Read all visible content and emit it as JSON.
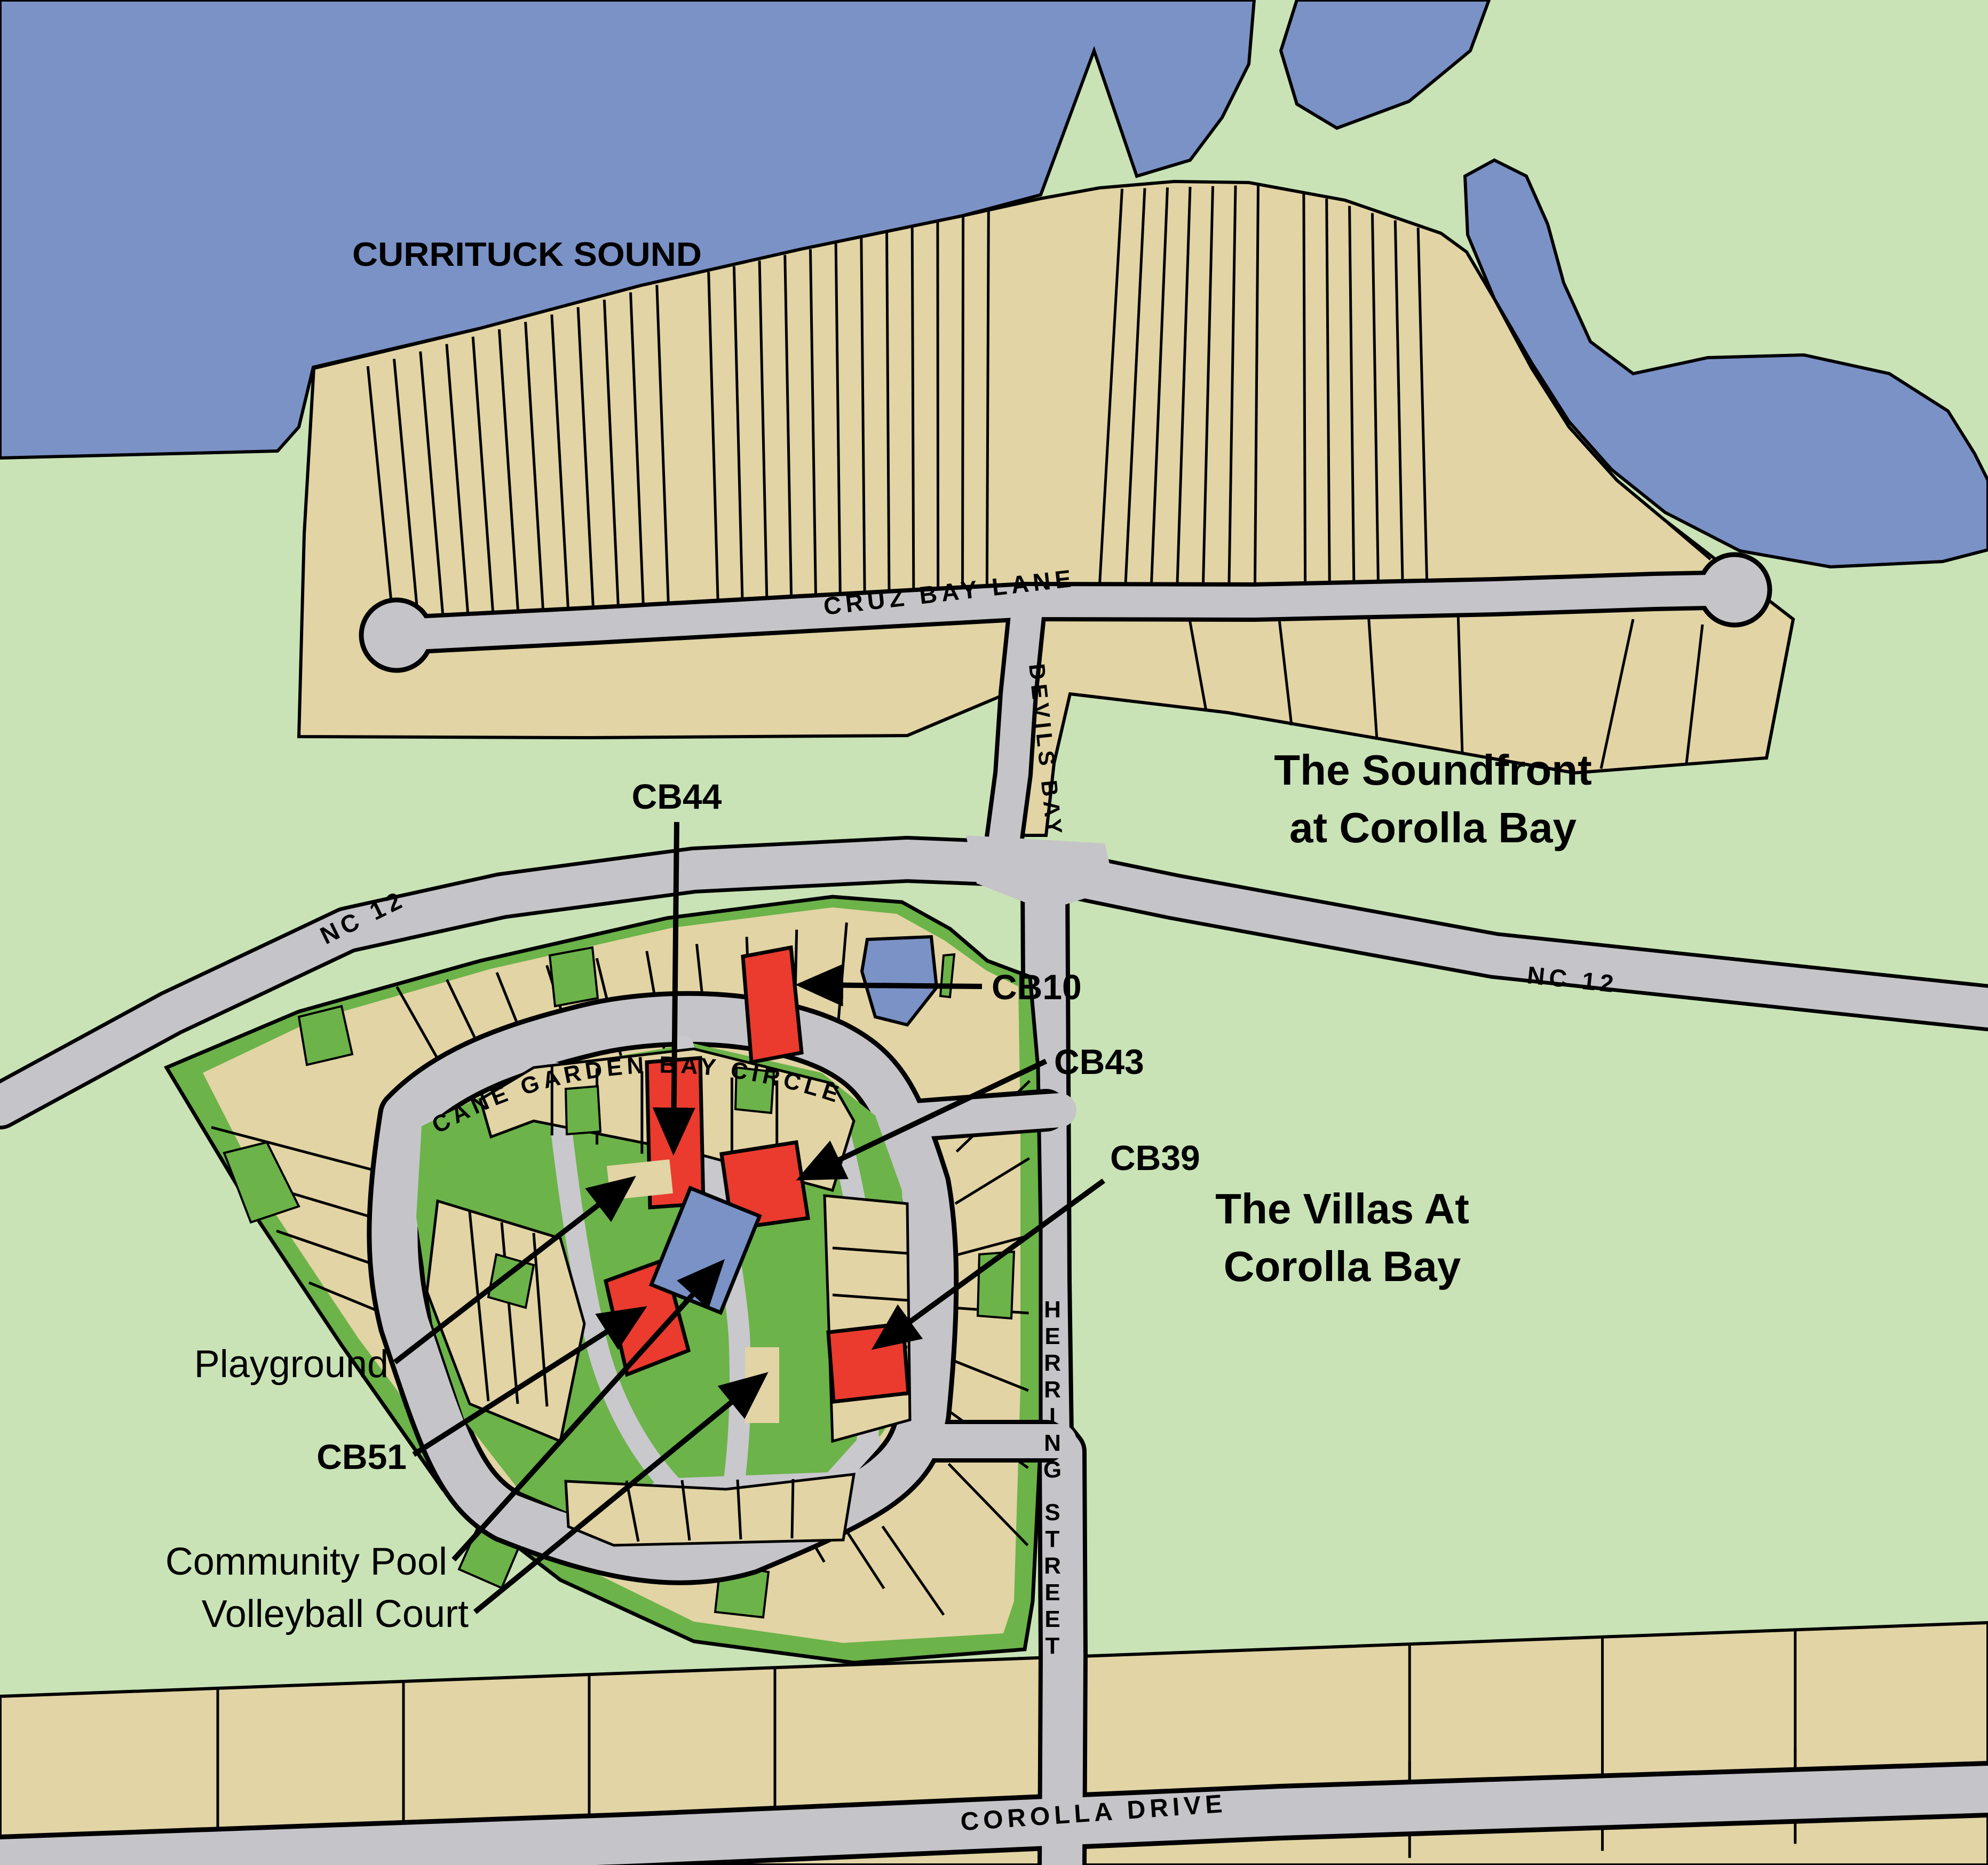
{
  "map": {
    "water_label": "CURRITUCK SOUND",
    "areas": {
      "soundfront_line1": "The Soundfront",
      "soundfront_line2": "at Corolla Bay",
      "villas_line1": "The Villas At",
      "villas_line2": "Corolla Bay"
    },
    "roads": {
      "cruz_bay_lane": "CRUZ BAY LANE",
      "devils_bay": "DEVILS BAY",
      "nc12_west": "NC 12",
      "nc12_east": "NC 12",
      "cane_garden_bay_circle": "CANE GARDEN BAY CIRCLE",
      "herring_street": "HERRING STREET",
      "corolla_drive": "COROLLA DRIVE"
    },
    "callouts": {
      "cb44": "CB44",
      "cb10": "CB10",
      "cb43": "CB43",
      "cb39": "CB39",
      "cb51": "CB51",
      "playground": "Playground",
      "community_pool": "Community Pool",
      "volleyball_court": "Volleyball Court"
    },
    "colors": {
      "water": "#7b92c6",
      "land": "#c9e3b6",
      "community_green": "#6cb34a",
      "lot_tan": "#e2d4a4",
      "road_gray": "#c5c4c8",
      "highlight_red": "#ea3b2e",
      "outline": "#000000"
    }
  }
}
